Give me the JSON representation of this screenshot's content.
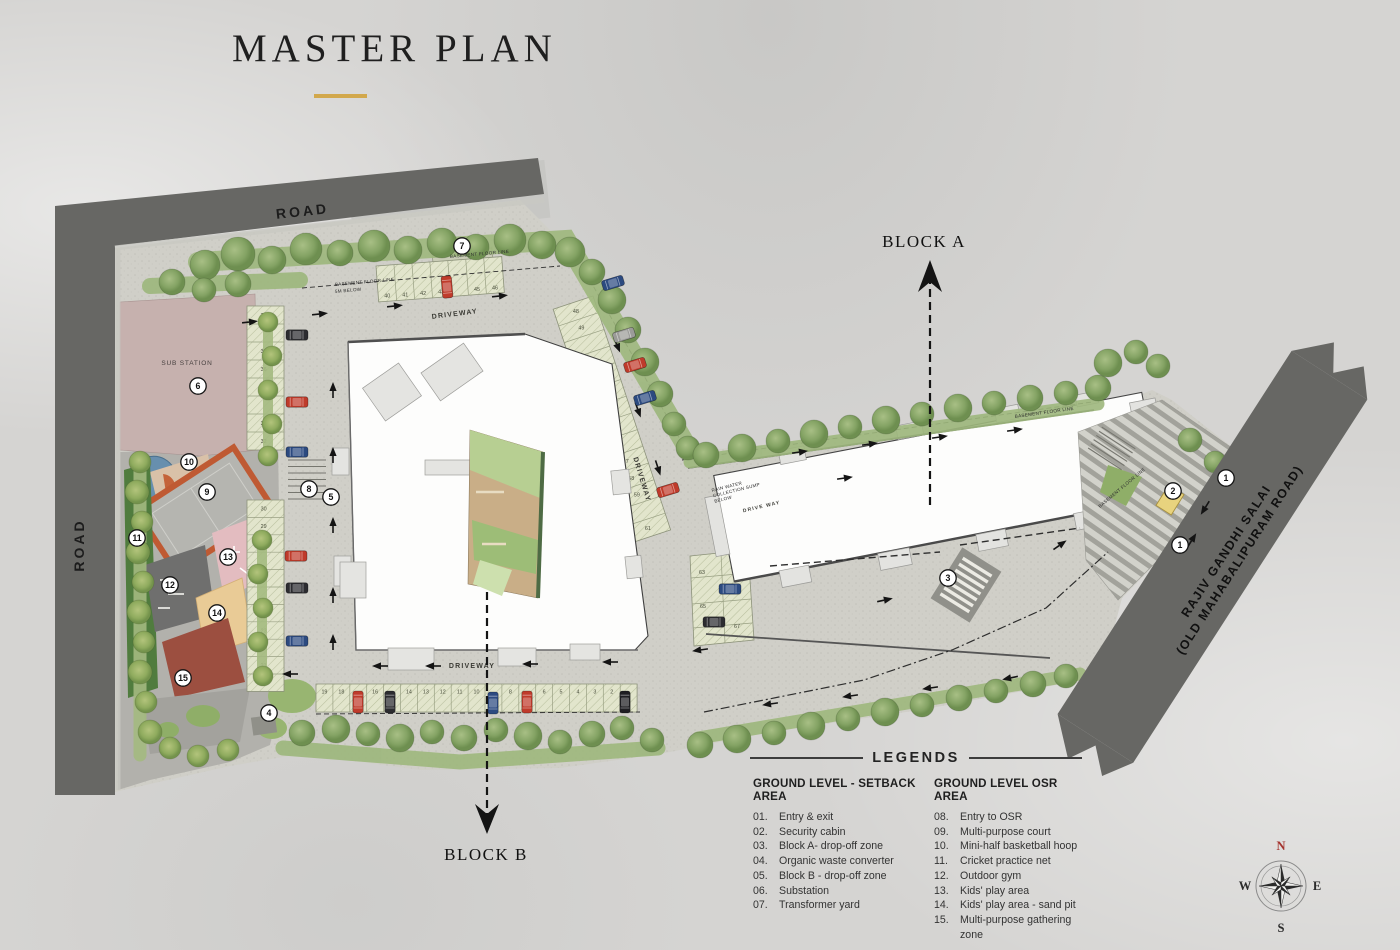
{
  "title": "MASTER PLAN",
  "plan": {
    "roads": {
      "top": "ROAD",
      "left": "ROAD",
      "right_line1": "RAJIV GANDHI SALAI",
      "right_line2": "(OLD MAHABALIPURAM ROAD)"
    },
    "blocks": {
      "a": "BLOCK A",
      "b": "BLOCK B"
    },
    "labels": {
      "sub_station": "SUB STATION",
      "driveway": "DRIVEWAY",
      "drive_way": "DRIVE WAY",
      "basement_line": "BASEMENT FLOOR LINE",
      "basement_sub": "5M BELOW",
      "rain_sump_1": "RAIN WATER",
      "rain_sump_2": "COLLECTION SUMP",
      "rain_sump_3": "BELOW"
    },
    "markers": [
      {
        "n": "1",
        "x": 1226,
        "y": 478
      },
      {
        "n": "2",
        "x": 1173,
        "y": 491
      },
      {
        "n": "1",
        "x": 1180,
        "y": 545
      },
      {
        "n": "3",
        "x": 948,
        "y": 578
      },
      {
        "n": "4",
        "x": 269,
        "y": 713
      },
      {
        "n": "5",
        "x": 331,
        "y": 497
      },
      {
        "n": "6",
        "x": 198,
        "y": 386
      },
      {
        "n": "7",
        "x": 462,
        "y": 246
      },
      {
        "n": "8",
        "x": 309,
        "y": 489
      },
      {
        "n": "9",
        "x": 207,
        "y": 492
      },
      {
        "n": "10",
        "x": 189,
        "y": 462
      },
      {
        "n": "11",
        "x": 137,
        "y": 538
      },
      {
        "n": "12",
        "x": 170,
        "y": 585
      },
      {
        "n": "13",
        "x": 228,
        "y": 557
      },
      {
        "n": "14",
        "x": 217,
        "y": 613
      },
      {
        "n": "15",
        "x": 183,
        "y": 678
      }
    ],
    "parking": {
      "left_col_upper": [
        "39",
        null,
        "37",
        "36",
        "35",
        null,
        "33",
        "32"
      ],
      "left_col_lower": [
        "30",
        "29",
        "28",
        null,
        "26",
        null,
        "24",
        "23",
        null,
        "21",
        "20"
      ],
      "top_row": [
        "40",
        "41",
        "42",
        "43",
        null,
        "45",
        "46"
      ],
      "right_col": [
        "48",
        "49",
        null,
        "51",
        null,
        "53",
        null,
        "55",
        "56",
        "57",
        "58",
        "59",
        null,
        "61"
      ],
      "bottom_row": [
        "19",
        "18",
        null,
        "16",
        null,
        "14",
        "13",
        "12",
        "11",
        "10",
        null,
        "8",
        null,
        "6",
        "5",
        "4",
        "3",
        "2",
        null
      ],
      "cluster": [
        "63",
        "62",
        "65",
        "67"
      ]
    }
  },
  "legends": {
    "heading": "LEGENDS",
    "columns": [
      {
        "title": "GROUND LEVEL - SETBACK AREA",
        "items": [
          {
            "num": "01.",
            "label": "Entry & exit"
          },
          {
            "num": "02.",
            "label": "Security cabin"
          },
          {
            "num": "03.",
            "label": "Block A- drop-off zone"
          },
          {
            "num": "04.",
            "label": "Organic waste converter"
          },
          {
            "num": "05.",
            "label": "Block B - drop-off zone"
          },
          {
            "num": "06.",
            "label": "Substation"
          },
          {
            "num": "07.",
            "label": "Transformer yard"
          }
        ]
      },
      {
        "title": "GROUND LEVEL OSR AREA",
        "items": [
          {
            "num": "08.",
            "label": "Entry to OSR"
          },
          {
            "num": "09.",
            "label": "Multi-purpose court"
          },
          {
            "num": "10.",
            "label": "Mini-half basketball hoop"
          },
          {
            "num": "11.",
            "label": "Cricket practice net"
          },
          {
            "num": "12.",
            "label": "Outdoor gym"
          },
          {
            "num": "13.",
            "label": "Kids' play area"
          },
          {
            "num": "14.",
            "label": "Kids' play area - sand pit"
          },
          {
            "num": "15.",
            "label": "Multi-purpose gathering zone"
          }
        ]
      }
    ]
  },
  "compass": {
    "n": "N",
    "e": "E",
    "s": "S",
    "w": "W"
  },
  "colors": {
    "accent_gold": "#d2a84c",
    "road": "#676764",
    "site": "#d0cfc8",
    "tree": "#7c9c5b"
  }
}
